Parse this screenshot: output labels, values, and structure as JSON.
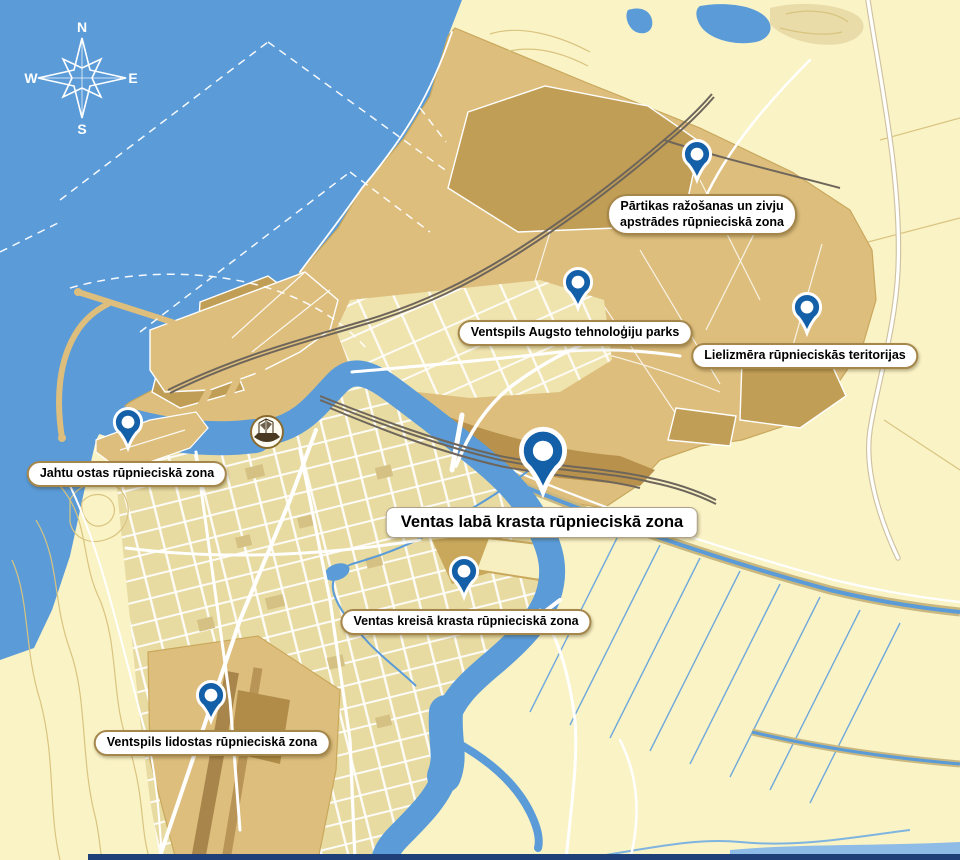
{
  "map_title": "Ventspils industrial zones map",
  "compass": {
    "n": "N",
    "e": "E",
    "s": "S",
    "w": "W"
  },
  "colors": {
    "sea": "#5A9BD8",
    "land": "#FAF3C6",
    "industrial": "#DDBE7D",
    "industrial_dark": "#C19E55",
    "industrial_darker": "#A8854A",
    "city_blocks": "#E8DBA2",
    "pin_blue": "#1460A8",
    "label_border": "#A5874B",
    "rail": "#6F665B",
    "ditch": "#70A9DD",
    "contour": "#D9C47F"
  },
  "zones": [
    {
      "id": "partikas",
      "lines": [
        "Pārtikas ražošanas un zivju",
        "apstrādes rūpnieciskā zona"
      ],
      "pin": {
        "x": 697,
        "y": 180,
        "scale": 0.85
      },
      "label": {
        "x": 702,
        "y": 194,
        "size": "small"
      }
    },
    {
      "id": "augsto-tehnologiju-parks",
      "lines": [
        "Ventspils Augsto tehnoloģiju parks"
      ],
      "pin": {
        "x": 578,
        "y": 308,
        "scale": 0.85
      },
      "label": {
        "x": 575,
        "y": 320,
        "size": "small"
      }
    },
    {
      "id": "lielizmera",
      "lines": [
        "Lielizmēra rūpnieciskās teritorijas"
      ],
      "pin": {
        "x": 807,
        "y": 333,
        "scale": 0.85
      },
      "label": {
        "x": 805,
        "y": 343,
        "size": "small"
      }
    },
    {
      "id": "jahtu-ostas",
      "lines": [
        "Jahtu ostas rūpnieciskā zona"
      ],
      "pin": {
        "x": 128,
        "y": 448,
        "scale": 0.85
      },
      "label": {
        "x": 127,
        "y": 461,
        "size": "small"
      }
    },
    {
      "id": "ventas-laba-krasta",
      "lines": [
        "Ventas labā krasta rūpnieciskā zona"
      ],
      "pin": {
        "x": 543,
        "y": 492,
        "scale": 1.35
      },
      "label": {
        "x": 542,
        "y": 507,
        "size": "large"
      }
    },
    {
      "id": "ventas-kreisa-krasta",
      "lines": [
        "Ventas kreisā krasta rūpnieciskā zona"
      ],
      "pin": {
        "x": 464,
        "y": 597,
        "scale": 0.85
      },
      "label": {
        "x": 466,
        "y": 609,
        "size": "small"
      }
    },
    {
      "id": "ventspils-lidostas",
      "lines": [
        "Ventspils lidostas rūpnieciskā zona"
      ],
      "pin": {
        "x": 211,
        "y": 721,
        "scale": 0.85
      },
      "label": {
        "x": 212,
        "y": 730,
        "size": "small"
      }
    }
  ],
  "emblem_name": "ventspils-ship-emblem"
}
